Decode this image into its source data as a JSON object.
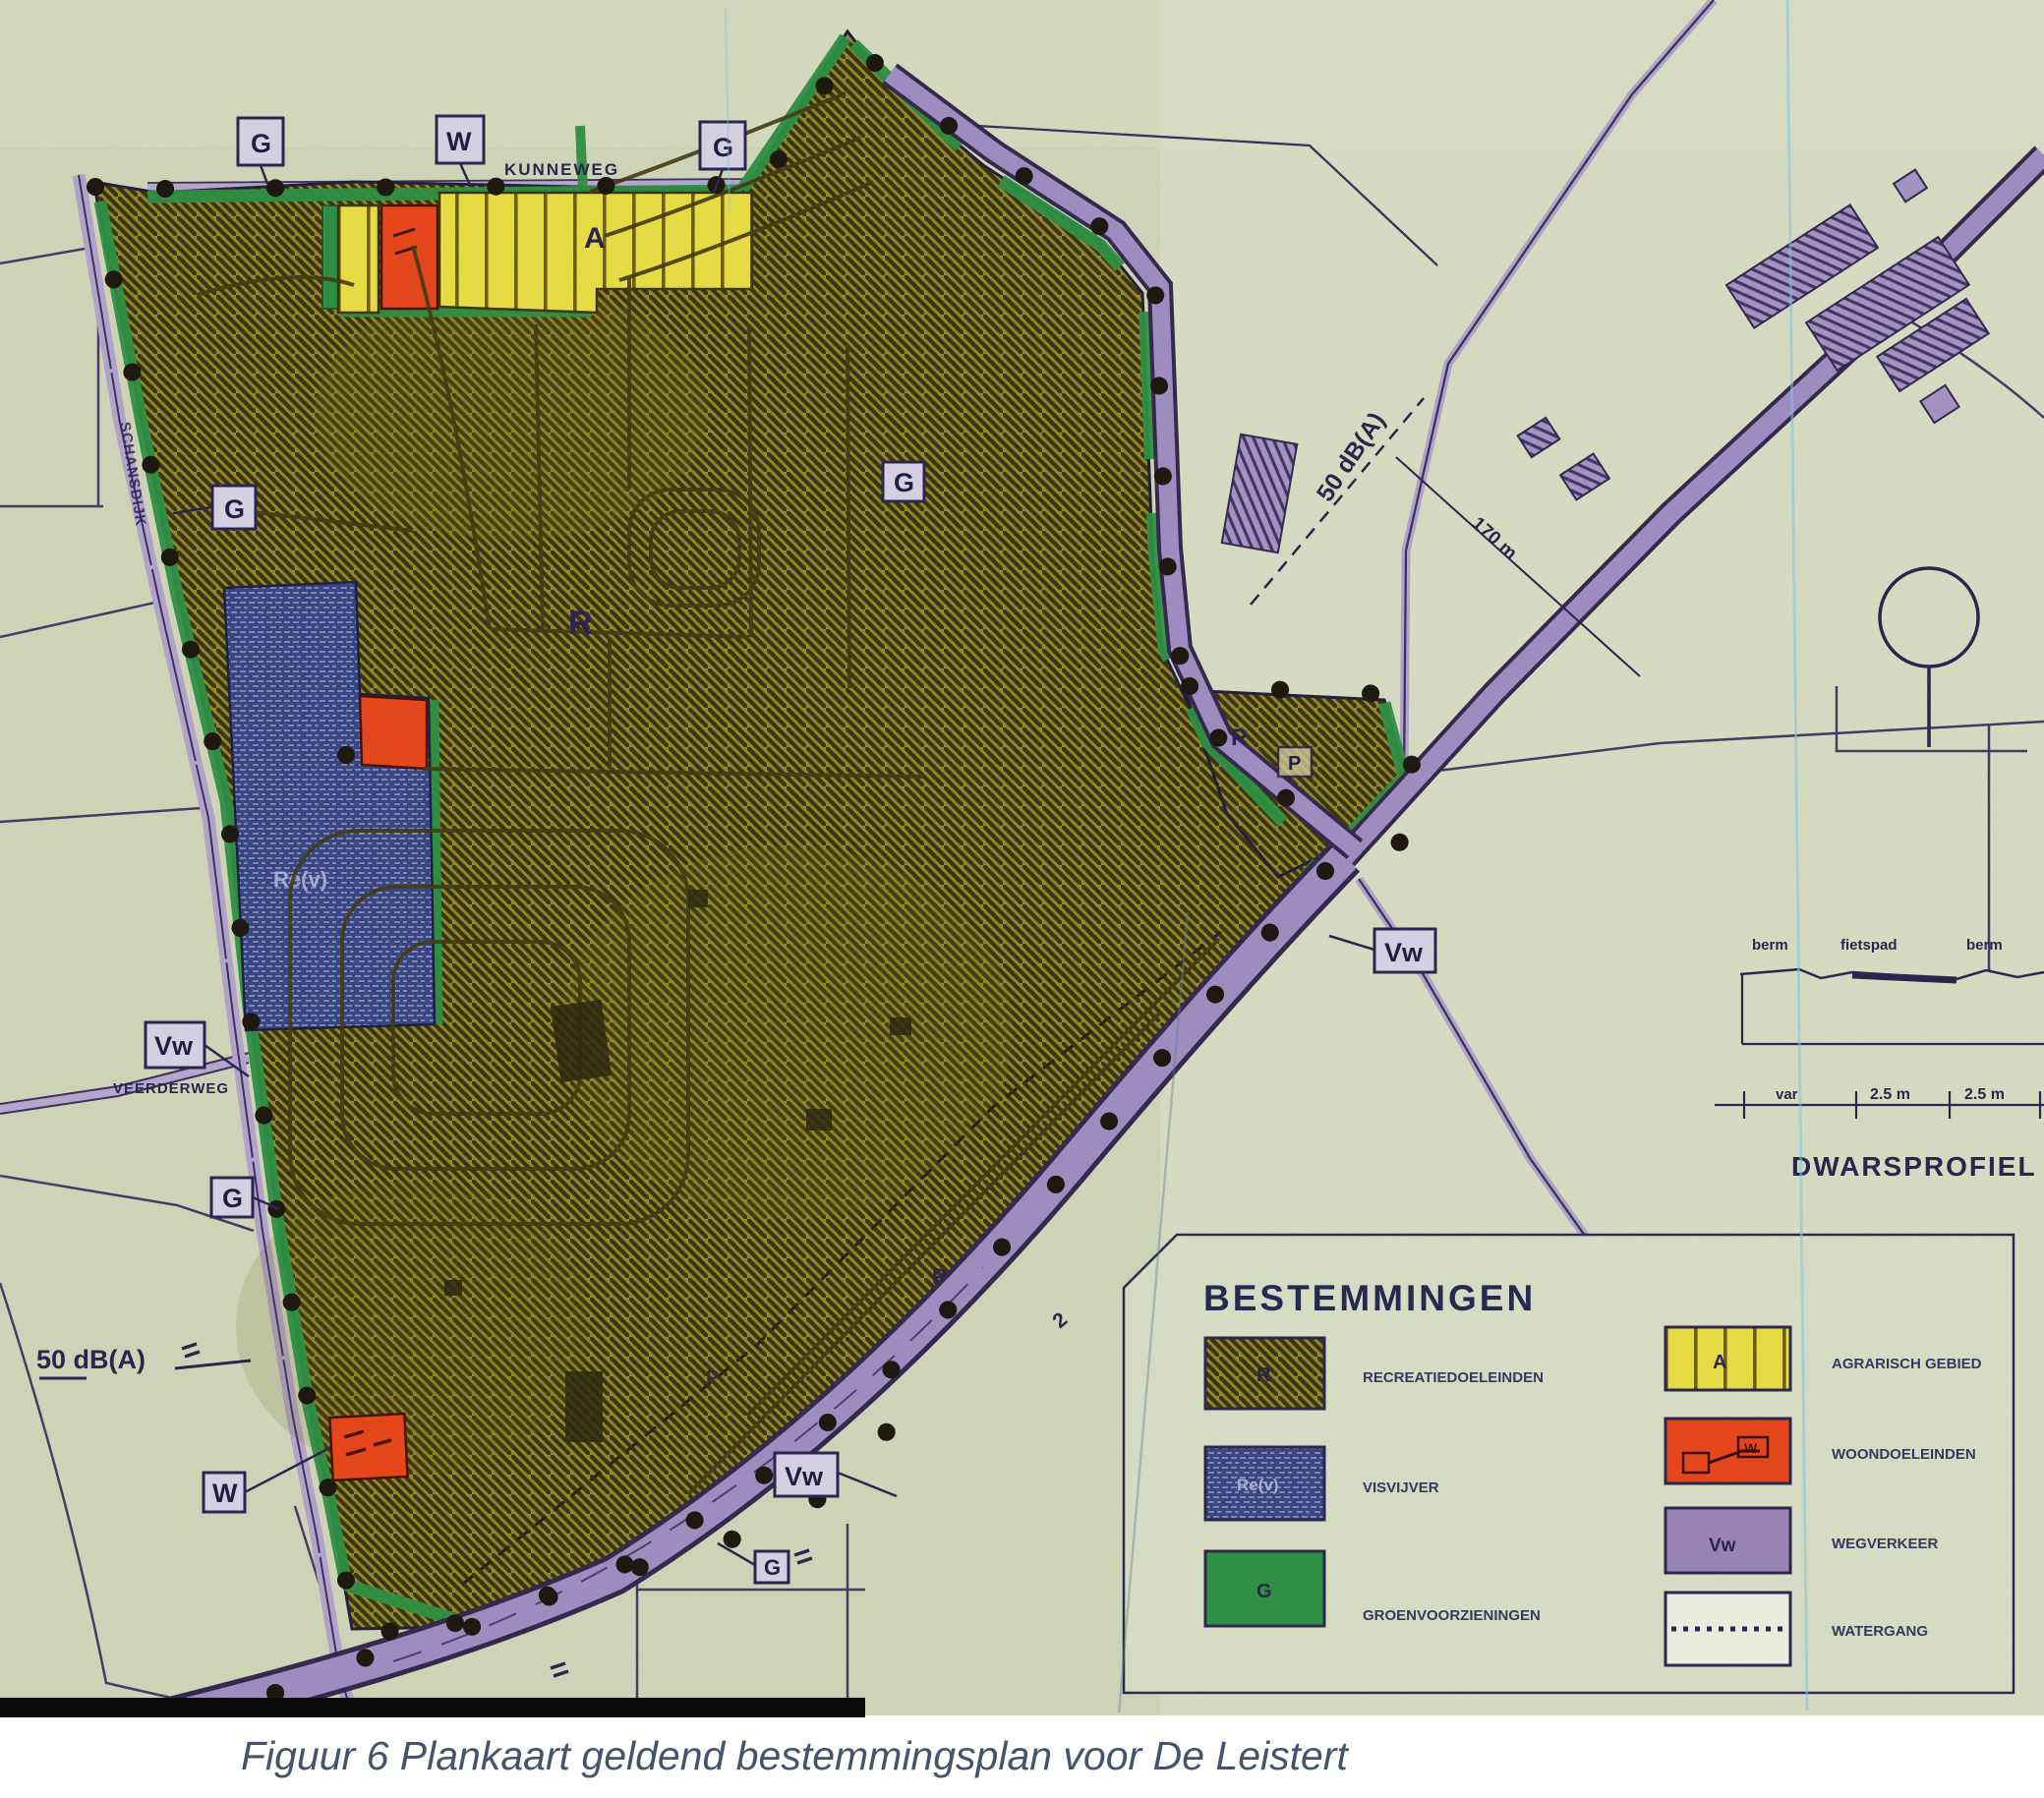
{
  "figure": {
    "caption": "Figuur 6 Plankaart geldend bestemmingsplan voor De Leistert"
  },
  "legend": {
    "title": "BESTEMMINGEN",
    "items_left": [
      {
        "code": "R",
        "label": "RECREATIEDOELEINDEN",
        "color": "#99922f",
        "style": "olive-hatch"
      },
      {
        "code": "Re(v)",
        "label": "VISVIJVER",
        "color": "#3a4783",
        "style": "blue-brick"
      },
      {
        "code": "G",
        "label": "GROENVOORZIENINGEN",
        "color": "#2f9145",
        "style": "green-solid"
      }
    ],
    "items_right": [
      {
        "code": "A",
        "label": "AGRARISCH GEBIED",
        "color": "#eadf45",
        "style": "yellow-stripes"
      },
      {
        "code": "W",
        "label": "WOONDOELEINDEN",
        "color": "#e8481b",
        "style": "orange-solid"
      },
      {
        "code": "Vw",
        "label": "WEGVERKEER",
        "color": "#9b87b8",
        "style": "purple-solid"
      },
      {
        "code": "",
        "label": "WATERGANG",
        "color": "#ffffff",
        "style": "dashed-line"
      }
    ]
  },
  "map": {
    "road_names": {
      "kunneweg": "KUNNEWEG",
      "schansdijk": "SCHANSDIJK",
      "veerderweg": "VEERDERWEG"
    },
    "area_codes": {
      "r": "R",
      "a": "A",
      "rev": "Re(v)",
      "g": "G",
      "w": "W",
      "vw": "Vw",
      "p": "P"
    },
    "annotations": {
      "noise_contour": "50 dB(A)",
      "distance": "170 m",
      "parcel_number": "2"
    },
    "profile": {
      "title": "DWARSPROFIEL",
      "berm_left": "berm",
      "fietspad": "fietspad",
      "berm_right": "berm",
      "dim_var": "var",
      "dim1": "2.5 m",
      "dim2": "2.5 m"
    }
  }
}
